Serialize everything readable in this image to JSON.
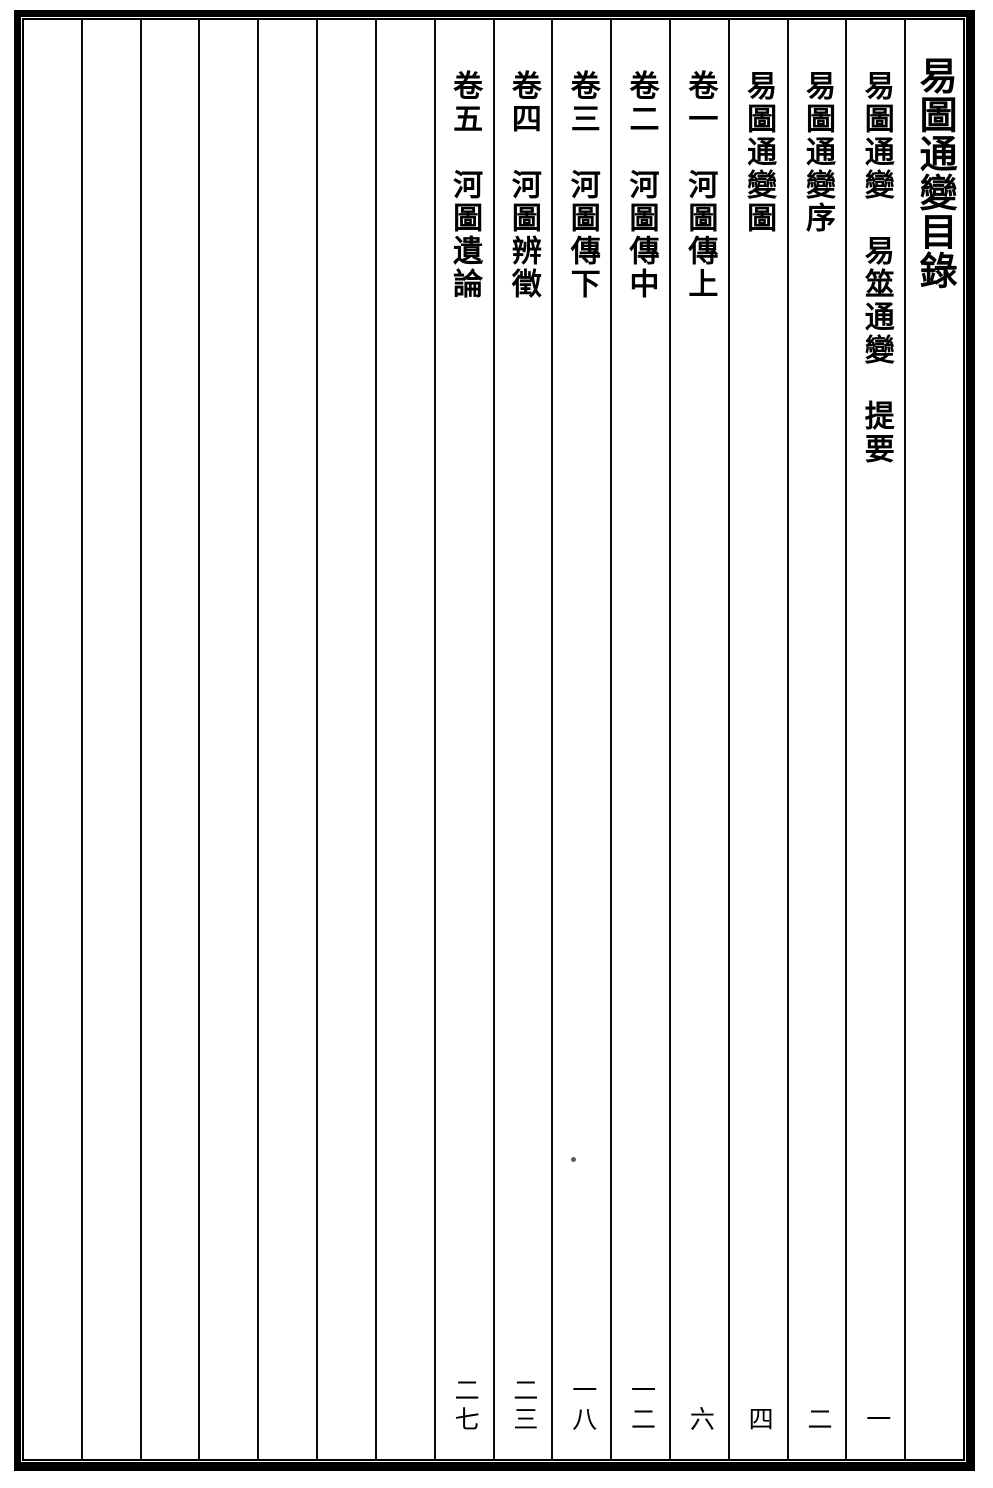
{
  "page": {
    "kind": "scanned woodblock-print book page",
    "language": "Classical Chinese",
    "reading_direction": "vertical right-to-left"
  },
  "toc": {
    "title": "易圖通變目錄",
    "entries": [
      {
        "text": "易圖通變　易筮通變　提要",
        "page": "一"
      },
      {
        "text": "易圖通變序",
        "page": "二"
      },
      {
        "text": "易圖通變圖",
        "page": "四"
      },
      {
        "text": "卷一　河圖傳上",
        "page": "六"
      },
      {
        "text": "卷二　河圖傳中",
        "page": "一二"
      },
      {
        "text": "卷三　河圖傳下",
        "page": "一八"
      },
      {
        "text": "卷四　河圖辨徵",
        "page": "二三"
      },
      {
        "text": "卷五　河圖遺論",
        "page": "二七"
      }
    ],
    "empty_column_count": 7
  },
  "colors": {
    "ink": "#000000",
    "paper": "#ffffff"
  }
}
